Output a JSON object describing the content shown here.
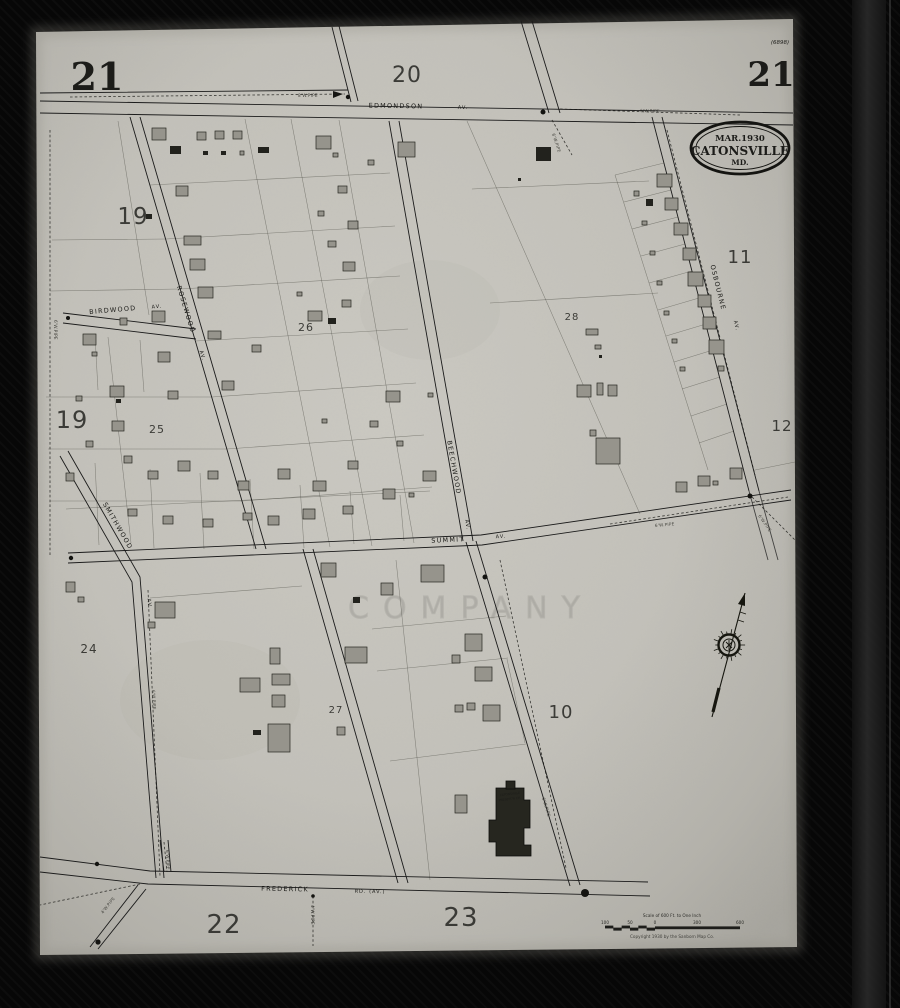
{
  "sheet": {
    "corner_left": "21",
    "adjacent_top": "20",
    "corner_right": "21",
    "plate_note": "(6898)"
  },
  "stamp": {
    "date": "MAR.1930",
    "city": "CATONSVILLE",
    "state": "MD."
  },
  "streets": {
    "edmondson": "EDMONDSON",
    "edmondson_av": "AV.",
    "birdwood": "BIRDWOOD",
    "birdwood_av": "AV.",
    "rosewood": "ROSEWOOD",
    "rosewood_av": "AV.",
    "beechwood": "BEECHWOOD",
    "beechwood_av": "AV.",
    "summit": "SUMMIT",
    "summit_av": "AV.",
    "smithwood": "SMITHWOOD",
    "smithwood_av": "AV.",
    "osbourne": "OSBOURNE",
    "osbourne_av": "AV.",
    "frederick": "FREDERICK",
    "frederick_suffix": "RD. (AV.)"
  },
  "numbers": [
    {
      "label": "19"
    },
    {
      "label": "19"
    },
    {
      "label": "25"
    },
    {
      "label": "26"
    },
    {
      "label": "28"
    },
    {
      "label": "11"
    },
    {
      "label": "12"
    },
    {
      "label": "24"
    },
    {
      "label": "27"
    },
    {
      "label": "10"
    },
    {
      "label": "22"
    },
    {
      "label": "23"
    }
  ],
  "church": {
    "line1": "CATONSVILLE",
    "line2": "PRESBYT'N CH."
  },
  "annotations": [
    {
      "text": "8'W.PIPE"
    },
    {
      "text": "6'W.PIPE"
    },
    {
      "text": "6'W.PIPE"
    },
    {
      "text": "6'W.PIPE"
    },
    {
      "text": "6'W.PIPE"
    },
    {
      "text": "4'W.PIPE"
    },
    {
      "text": "4'W.PIPE"
    },
    {
      "text": "6'W.PIPE"
    },
    {
      "text": "6'W.PIPE"
    },
    {
      "text": "6'W.PIPE"
    },
    {
      "text": "6'W.PIPE"
    }
  ],
  "scale_bar": {
    "title": "Scale of 600 Ft. to One Inch",
    "ticks": [
      "100",
      "50",
      "0",
      "300",
      "600"
    ],
    "copyright": "Copyright 1930 by the Sanborn Map Co."
  },
  "watermark": "COMPANY",
  "colors": {
    "paper": "#c7c5be",
    "ink": "#1b1b1b",
    "building_gray": "#96948c",
    "building_dark": "#22221d"
  }
}
